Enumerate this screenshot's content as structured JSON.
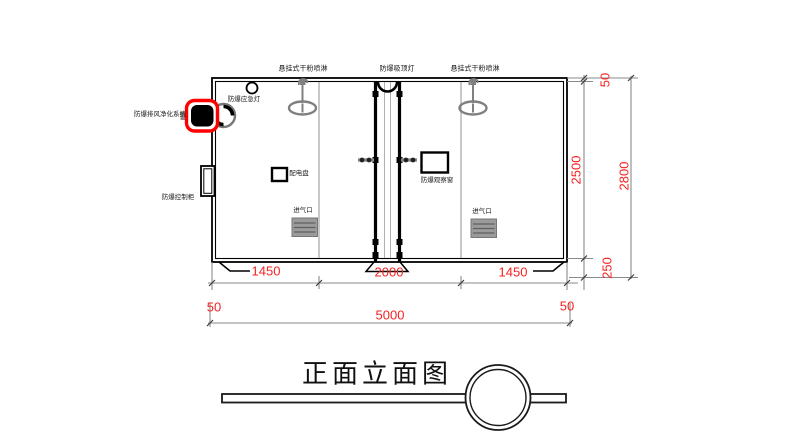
{
  "drawing": {
    "title": "正面立面图"
  },
  "labels": {
    "sprinkler_left": "悬挂式干粉喷淋",
    "ceiling_lamp": "防爆吸顶灯",
    "sprinkler_right": "悬挂式干粉喷淋",
    "emergency_lamp": "防爆应急灯",
    "exhaust_system": "防爆排风净化系统",
    "control_cabinet": "防爆控制柜",
    "power_panel": "配电盘",
    "observation_window": "防爆观察窗",
    "air_inlet_left": "进气口",
    "air_inlet_right": "进气口"
  },
  "dimensions": {
    "bottom_row1": [
      "1450",
      "2000",
      "1450"
    ],
    "bottom_left_wall": "50",
    "bottom_total": "5000",
    "bottom_right_wall": "50",
    "right_top": "50",
    "right_inner_height": "2500",
    "right_total_height": "2800",
    "right_base": "250"
  },
  "colors": {
    "dimension_text": "#f52222",
    "highlight_outline": "#ff0000",
    "drawing_line": "#000000",
    "dim_line": "#8a8a8a"
  }
}
